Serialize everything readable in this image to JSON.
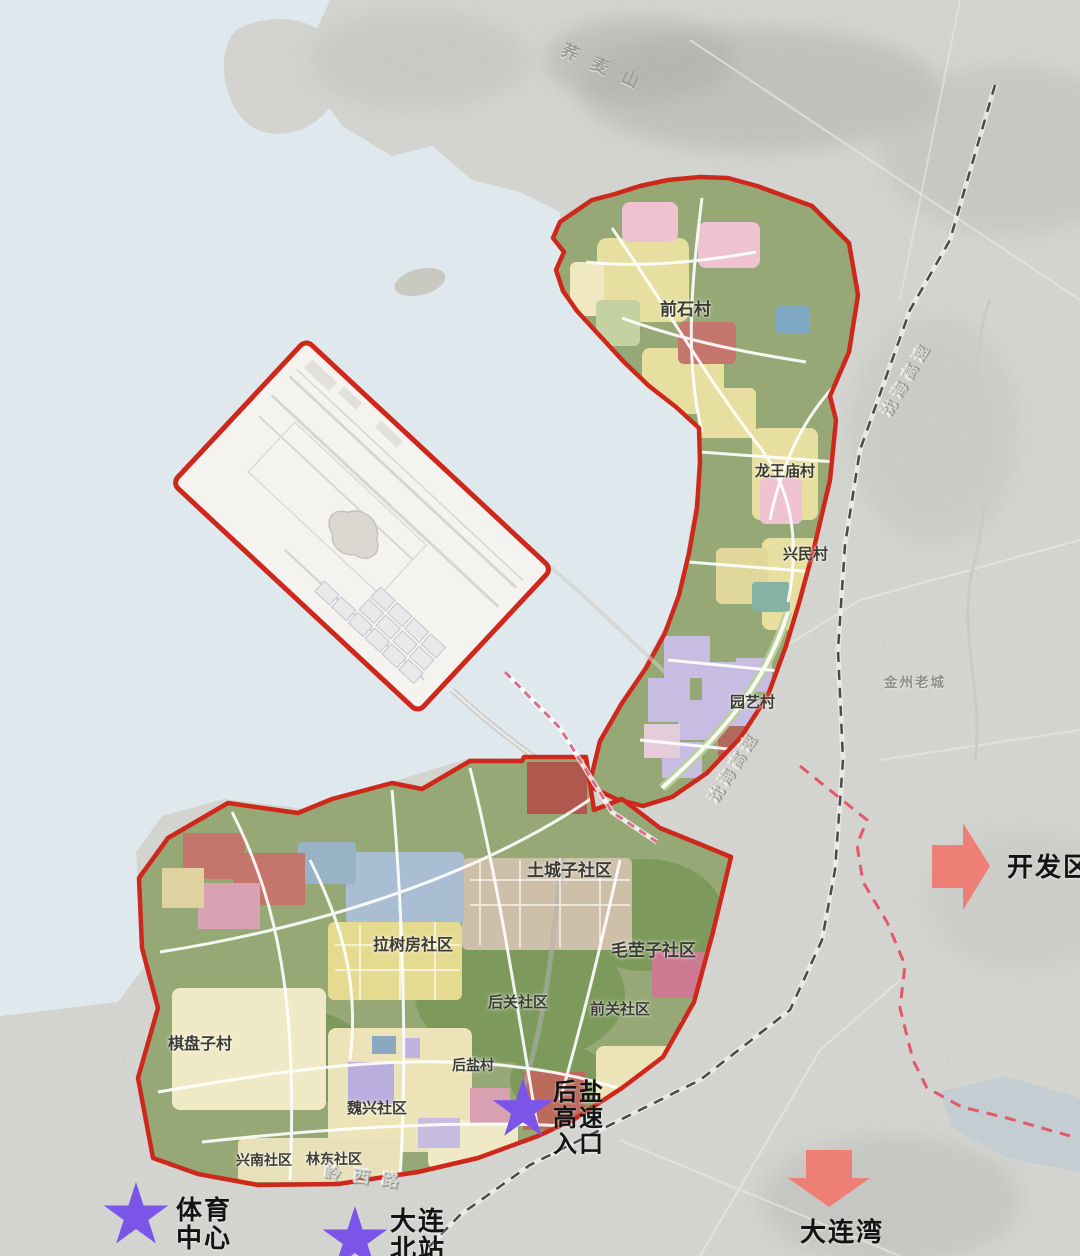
{
  "regions": {
    "qianshi": "前石村",
    "longwangmiao": "龙王庙村",
    "xingmin": "兴民村",
    "yuanyi": "园艺村",
    "tucheng": "土城子社区",
    "lashufang": "拉树房社区",
    "maoying": "毛茔子社区",
    "houguan": "后关社区",
    "qianguan": "前关社区",
    "qipanzi": "棋盘子村",
    "houyancun": "后盐村",
    "weixing": "魏兴社区",
    "xingnan": "兴南社区",
    "lindong": "林东社区"
  },
  "places": {
    "mountain": "荞麦山",
    "old_town": "金州老城",
    "expressway_ne": "沈海高速",
    "expressway_mid": "沈海高速",
    "road_south": "岭西路"
  },
  "markers": {
    "sports_center": {
      "line1": "体育",
      "line2": "中心"
    },
    "north_station": {
      "line1": "大连",
      "line2": "北站"
    },
    "houyan_ic": {
      "line1": "后盐",
      "line2": "高速",
      "line3": "入口"
    }
  },
  "arrows": {
    "dev_zone": "开发区",
    "dalian_bay": "大连湾"
  },
  "colors": {
    "boundary_red": "#ce281c",
    "star_purple": "#7a55e8",
    "arrow_salmon": "#ee7f76",
    "water": "#dfe9ed",
    "zone_green": "#96a875",
    "dashed_rail": "#4a4a4a",
    "dashed_pink": "#e25a6a"
  }
}
